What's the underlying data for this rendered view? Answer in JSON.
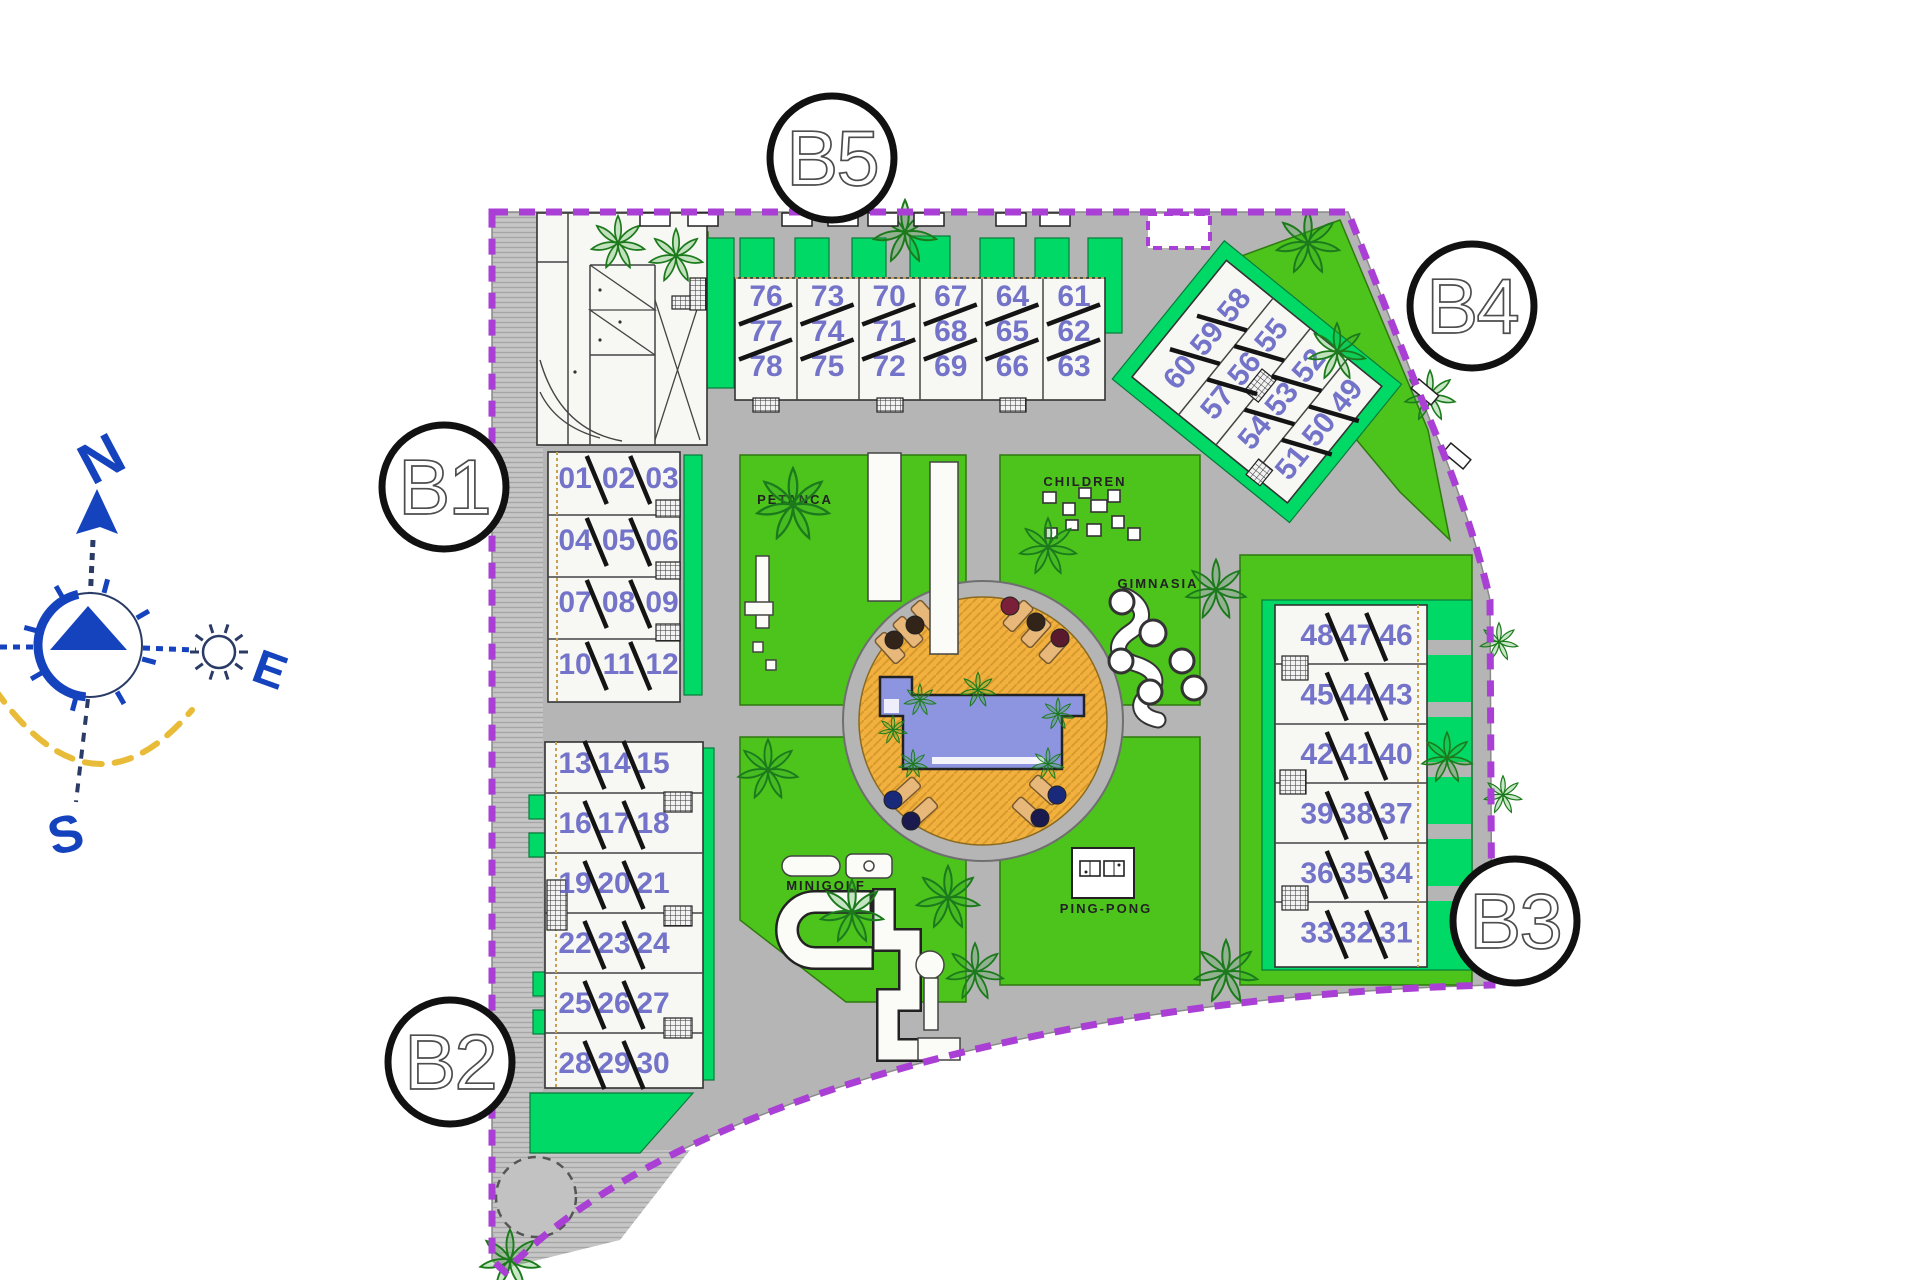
{
  "compass": {
    "north": "N",
    "east": "E",
    "south": "S"
  },
  "badges": {
    "b1": "B1",
    "b2": "B2",
    "b3": "B3",
    "b4": "B4",
    "b5": "B5"
  },
  "amenities": {
    "petanca": "PETANCA",
    "children": "CHILDREN",
    "gimnasia": "GIMNASIA",
    "minigolf": "MINIGOLF",
    "pingpong": "PING-PONG"
  },
  "blocks": {
    "b5": {
      "columns": [
        [
          "76",
          "77",
          "78"
        ],
        [
          "73",
          "74",
          "75"
        ],
        [
          "70",
          "71",
          "72"
        ],
        [
          "67",
          "68",
          "69"
        ],
        [
          "64",
          "65",
          "66"
        ],
        [
          "61",
          "62",
          "63"
        ]
      ]
    },
    "b1_upper": {
      "rows": [
        [
          "01",
          "02",
          "03"
        ],
        [
          "04",
          "05",
          "06"
        ],
        [
          "07",
          "08",
          "09"
        ],
        [
          "10",
          "11",
          "12"
        ]
      ]
    },
    "b1_lower": {
      "rows": [
        [
          "13",
          "14",
          "15"
        ],
        [
          "16",
          "17",
          "18"
        ],
        [
          "19",
          "20",
          "21"
        ],
        [
          "22",
          "23",
          "24"
        ],
        [
          "25",
          "26",
          "27"
        ],
        [
          "28",
          "29",
          "30"
        ]
      ]
    },
    "b4": {
      "rows": [
        [
          "60",
          "59",
          "58"
        ],
        [
          "57",
          "56",
          "55"
        ],
        [
          "54",
          "53",
          "52"
        ],
        [
          "51",
          "50",
          "49"
        ]
      ]
    },
    "b3": {
      "rows": [
        [
          "48",
          "47",
          "46"
        ],
        [
          "45",
          "44",
          "43"
        ],
        [
          "42",
          "41",
          "40"
        ],
        [
          "39",
          "38",
          "37"
        ],
        [
          "36",
          "35",
          "34"
        ],
        [
          "33",
          "32",
          "31"
        ]
      ]
    }
  },
  "colors": {
    "lawn": "#4cc41c",
    "spring_green": "#00d966",
    "road": "#b5b5b5",
    "boundary_purple": "#a93fd4",
    "pool_water": "#8d95e0",
    "pool_deck": "#f2b13e",
    "unit_number": "#6868c6",
    "compass_blue": "#1543be",
    "sun_path_yellow": "#e8bc38"
  }
}
